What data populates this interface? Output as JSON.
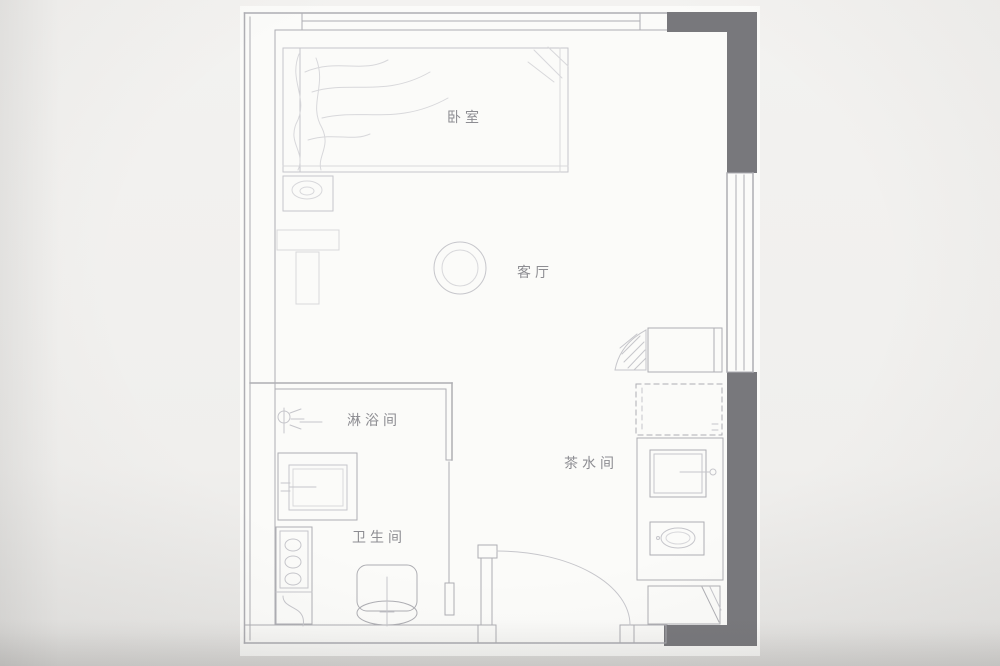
{
  "rooms": {
    "bedroom": "卧室",
    "living_room": "客厅",
    "shower_room": "淋浴间",
    "bathroom": "卫生间",
    "pantry": "茶水间"
  },
  "colors": {
    "background": "#efeeec",
    "paper": "#fbfbf9",
    "wall_dark": "#78787c",
    "line": "#aeaeb3",
    "line_faint": "#c6c6cb",
    "line_xfaint": "#d8d8db",
    "text": "#8d8d92"
  }
}
